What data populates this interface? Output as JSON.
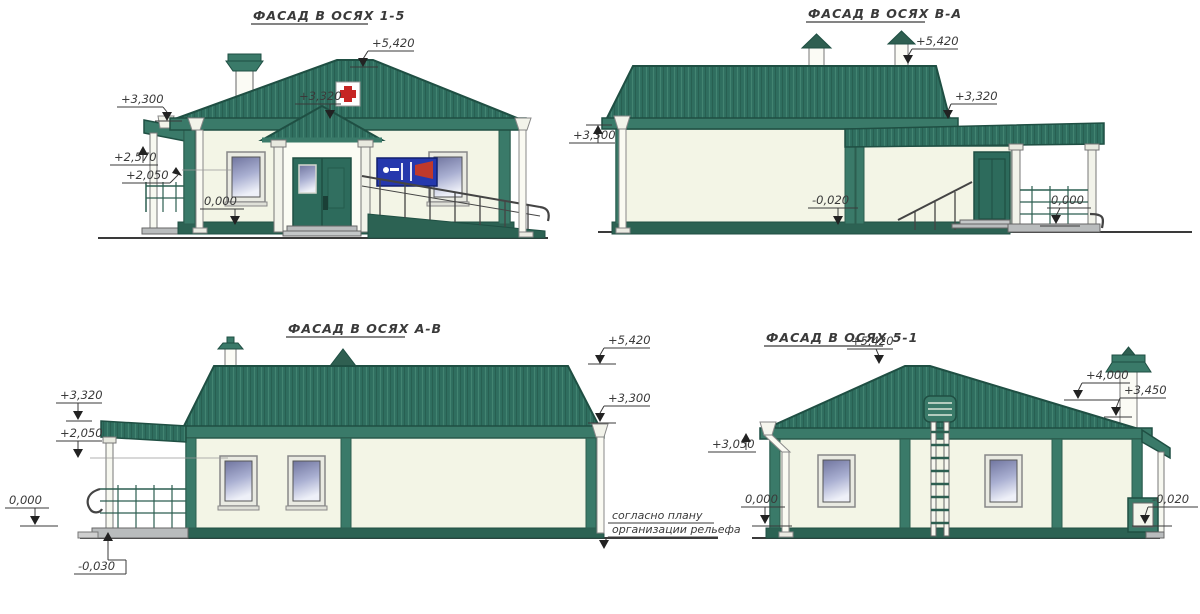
{
  "drawing": {
    "type": "architectural-elevations",
    "facades": [
      {
        "id": "1-5",
        "title": "ФАСАД В ОСЯХ 1-5",
        "marks": [
          {
            "label": "+5,420"
          },
          {
            "label": "+3,300"
          },
          {
            "label": "+3,320"
          },
          {
            "label": "+2,570"
          },
          {
            "label": "+2,050"
          },
          {
            "label": "0,000"
          }
        ]
      },
      {
        "id": "В-А",
        "title": "ФАСАД В ОСЯХ В-А",
        "marks": [
          {
            "label": "+5,420"
          },
          {
            "label": "+3,320"
          },
          {
            "label": "+3,300"
          },
          {
            "label": "-0,020"
          },
          {
            "label": "0,000"
          }
        ]
      },
      {
        "id": "А-В",
        "title": "ФАСАД В ОСЯХ А-В",
        "marks": [
          {
            "label": "+3,320"
          },
          {
            "label": "+2,050"
          },
          {
            "label": "0,000"
          },
          {
            "label": "-0,030"
          },
          {
            "label": "+5,420"
          },
          {
            "label": "+3,300"
          }
        ]
      },
      {
        "id": "5-1",
        "title": "ФАСАД В ОСЯХ 5-1",
        "marks": [
          {
            "label": "+5,420"
          },
          {
            "label": "+4,000"
          },
          {
            "label": "+3,450"
          },
          {
            "label": "+3,050"
          },
          {
            "label": "0,000"
          },
          {
            "label": "-0,020"
          }
        ]
      }
    ],
    "ground_note": {
      "line1": "согласно плану",
      "line2": "организации рельефа"
    },
    "symbols": {
      "roof_sign": "red-cross",
      "wall_sign": "blue-clinic-signboard"
    },
    "colors": {
      "roof_green": "#2f6e5f",
      "roof_stripe": "#45897575",
      "roof_dark": "#1f4f43",
      "trim_green": "#3a7a69",
      "wall_cream": "#f3f5e6",
      "plinth_green": "#2c6253",
      "door_green": "#2d6b5c",
      "glass_top": "#7b80b1",
      "glass_bottom": "#eef0f8",
      "sign_blue": "#2538ad",
      "cross_red": "#c62524",
      "line_gray": "#3a3a3a"
    }
  }
}
